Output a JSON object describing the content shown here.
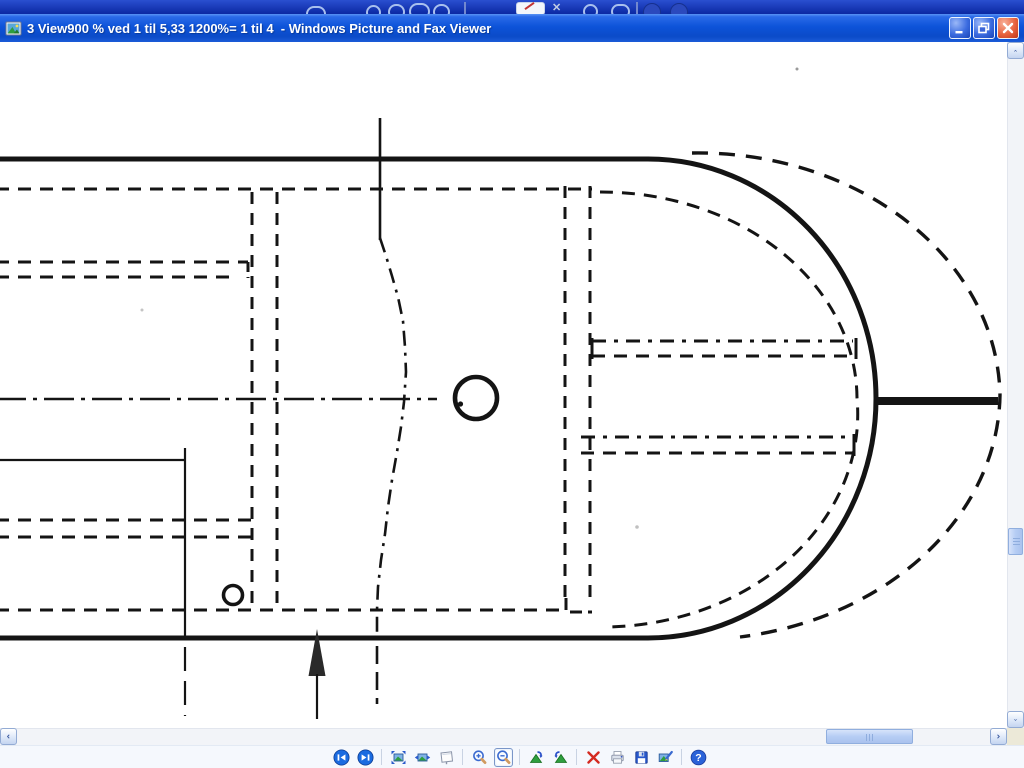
{
  "titlebar": {
    "title": "3 View900 % ved 1 til 5,33 1200%= 1 til 4  - Windows Picture and Fax Viewer",
    "app_name": "Windows Picture and Fax Viewer",
    "controls": [
      "minimize",
      "restore",
      "close"
    ]
  },
  "toolbar": {
    "buttons": [
      {
        "name": "previous-image"
      },
      {
        "name": "next-image"
      },
      {
        "name": "best-fit"
      },
      {
        "name": "actual-size"
      },
      {
        "name": "start-slideshow"
      },
      {
        "name": "zoom-in"
      },
      {
        "name": "zoom-out",
        "selected": true
      },
      {
        "name": "rotate-clockwise"
      },
      {
        "name": "rotate-counterclockwise"
      },
      {
        "name": "delete"
      },
      {
        "name": "print"
      },
      {
        "name": "save"
      },
      {
        "name": "edit"
      },
      {
        "name": "help"
      }
    ]
  },
  "scrollbars": {
    "vertical_thumb_top": 486,
    "vertical_thumb_height": 27,
    "horizontal_thumb_left": 826,
    "horizontal_thumb_width": 87
  },
  "colors": {
    "titlebar_blue": "#0d53d9",
    "close_red": "#e0583a",
    "top_strip_navy": "#0b28a2",
    "toolbar_bg": "#f5f8fd",
    "drawing_ink": "#141414",
    "canvas_white": "#ffffff"
  },
  "image_content": "black-and-white technical plan drawing of a rounded hull end with dashed internal outlines, centerline, circles and an up arrow"
}
